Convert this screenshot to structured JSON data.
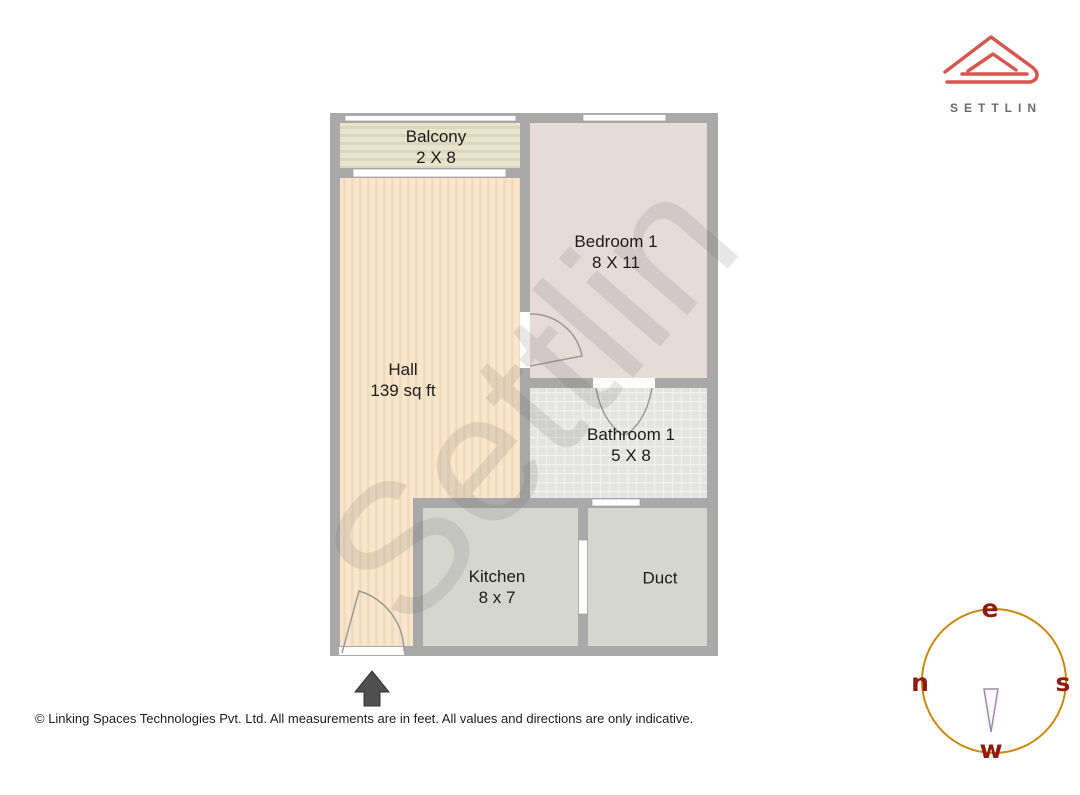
{
  "brand": {
    "name": "SETTLIN"
  },
  "plan": {
    "watermark": "Settlin",
    "rooms": [
      {
        "id": "balcony",
        "label": "Balcony",
        "dimensions": "2 X 8"
      },
      {
        "id": "bedroom-1",
        "label": "Bedroom 1",
        "dimensions": "8 X 11"
      },
      {
        "id": "hall",
        "label": "Hall",
        "dimensions": "139 sq ft"
      },
      {
        "id": "bathroom-1",
        "label": "Bathroom 1",
        "dimensions": "5 X 8"
      },
      {
        "id": "kitchen",
        "label": "Kitchen",
        "dimensions": "8 x 7"
      },
      {
        "id": "duct",
        "label": "Duct",
        "dimensions": ""
      }
    ]
  },
  "compass": {
    "top": "e",
    "left": "n",
    "right": "s",
    "bottom": "w"
  },
  "footer": {
    "disclaimer": "© Linking Spaces Technologies Pvt. Ltd. All measurements are in feet. All values and directions are only indicative."
  },
  "colors": {
    "wall": "#a9a9a9",
    "hall": "#f9e6cb",
    "hall_stripe": "#f2dcbf",
    "balcony": "#e9e4cc",
    "balcony_stripe": "#dcd6bc",
    "bedroom": "#e7dbda",
    "bathroom": "#e4e4e2",
    "bathroom_grid": "#f2f2f1",
    "kitchen": "#d6d6d1",
    "duct": "#d6d6d1",
    "logo": "#d5574f",
    "brand_text": "#6b6b6b",
    "compass_ring": "#c98a0d",
    "compass_letter": "#8e1c12",
    "needle_stroke": "#9d88aa"
  }
}
